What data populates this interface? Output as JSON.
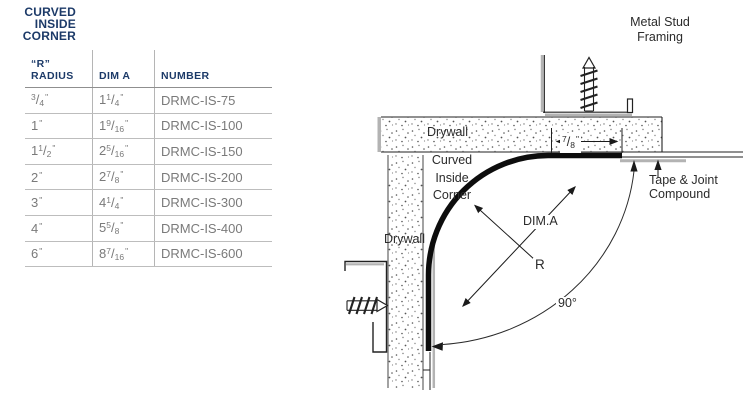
{
  "colors": {
    "navy": "#1c3a68",
    "body_gray": "#7a7a7a",
    "line_gray": "#b5b5b5",
    "ink": "#1a1a1a",
    "metal_gray": "#b3b3b3"
  },
  "title": {
    "lines": [
      "CURVED",
      "INSIDE",
      "CORNER"
    ]
  },
  "table": {
    "headers": [
      "“R” RADIUS",
      "DIM A",
      "NUMBER"
    ],
    "inch_mark": "\"",
    "rows": [
      {
        "radius": {
          "num": "3",
          "den": "4"
        },
        "dim_a": {
          "whole": "1",
          "num": "1",
          "den": "4"
        },
        "number": "DRMC-IS-75"
      },
      {
        "radius": {
          "whole": "1"
        },
        "dim_a": {
          "whole": "1",
          "num": "9",
          "den": "16"
        },
        "number": "DRMC-IS-100"
      },
      {
        "radius": {
          "whole": "1",
          "num": "1",
          "den": "2"
        },
        "dim_a": {
          "whole": "2",
          "num": "5",
          "den": "16"
        },
        "number": "DRMC-IS-150"
      },
      {
        "radius": {
          "whole": "2"
        },
        "dim_a": {
          "whole": "2",
          "num": "7",
          "den": "8"
        },
        "number": "DRMC-IS-200"
      },
      {
        "radius": {
          "whole": "3"
        },
        "dim_a": {
          "whole": "4",
          "num": "1",
          "den": "4"
        },
        "number": "DRMC-IS-300"
      },
      {
        "radius": {
          "whole": "4"
        },
        "dim_a": {
          "whole": "5",
          "num": "5",
          "den": "8"
        },
        "number": "DRMC-IS-400"
      },
      {
        "radius": {
          "whole": "6"
        },
        "dim_a": {
          "whole": "8",
          "num": "7",
          "den": "16"
        },
        "number": "DRMC-IS-600"
      }
    ]
  },
  "diagram": {
    "labels": {
      "metal_stud": [
        "Metal Stud",
        "Framing"
      ],
      "drywall_top": "Drywall",
      "drywall_side": "Drywall",
      "corner": [
        "Curved",
        "Inside",
        "Corner"
      ],
      "dim_a": "DIM.A",
      "radius": "R",
      "angle": "90°",
      "tape": [
        "Tape & Joint",
        "Compound"
      ],
      "flange_width": {
        "num": "7",
        "den": "8"
      }
    }
  }
}
